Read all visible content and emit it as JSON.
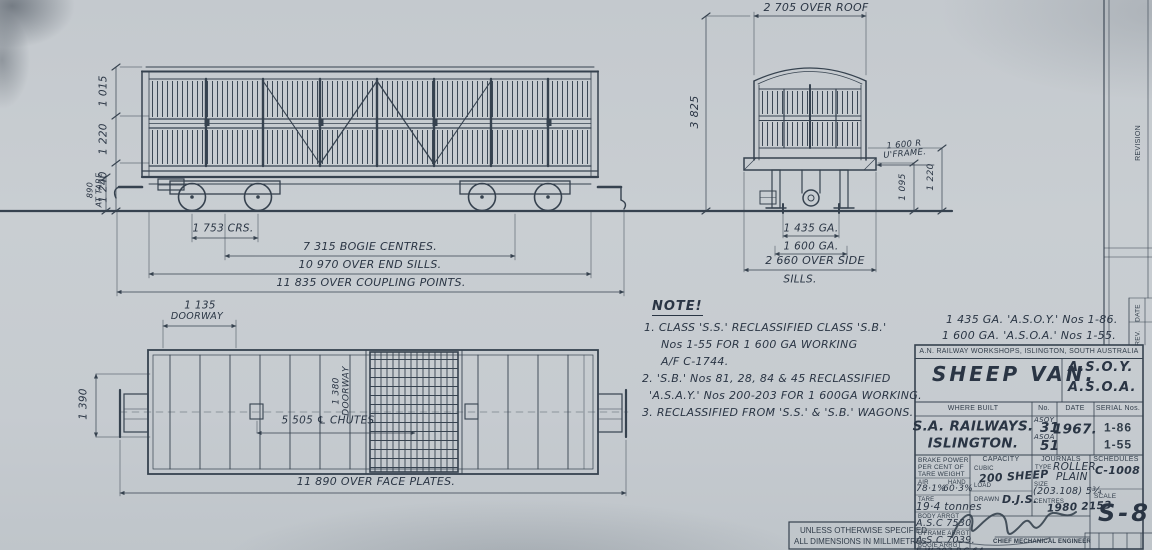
{
  "side_view": {
    "dim_top": "1 015",
    "dim_mid": "1 220",
    "dim_bottom": "1 240",
    "dim_tare_value": "890",
    "dim_tare_label": "AT TARE",
    "dim_crs": "1 753 CRS.",
    "dim_bogie_centres": "7 315 BOGIE CENTRES.",
    "dim_end_sills": "10 970 OVER END SILLS.",
    "dim_coupling": "11 835 OVER COUPLING POINTS."
  },
  "end_view": {
    "dim_over_roof": "2 705 OVER ROOF",
    "dim_height": "3 825",
    "dim_uframe_value": "1 600 R",
    "dim_uframe_label": "U'FRAME.",
    "dim_inner": "1 095",
    "dim_outer": "1 220",
    "dim_gauge_narrow": "1 435 GA.",
    "dim_gauge_broad": "1 600 GA.",
    "dim_side_sills": "2 660 OVER SIDE",
    "dim_side_sills2": "SILLS."
  },
  "plan_view": {
    "dim_end_door_value": "1 135",
    "dim_end_door_label": "DOORWAY",
    "dim_end_width": "1 390",
    "dim_side_door_value": "1 380",
    "dim_side_door_label": "DOORWAY",
    "dim_chutes": "5 505 ℄ CHUTES",
    "dim_face_plates": "11 890 OVER FACE PLATES."
  },
  "note": {
    "heading": "NOTE!",
    "lines": [
      "1. CLASS 'S.S.' RECLASSIFIED CLASS 'S.B.'",
      "Nos 1-55 FOR 1 600 GA WORKING",
      "A/F C-1744.",
      "2. 'S.B.' Nos 81, 28, 84 & 45 RECLASSIFIED",
      "'A.S.A.Y.' Nos 200-203 FOR 1 600GA WORKING.",
      "3. RECLASSIFIED FROM 'S.S.' & 'S.B.' WAGONS."
    ]
  },
  "gauge_note": {
    "line1": "1 435 GA. 'A.S.O.Y.' Nos 1-86.",
    "line2": "1 600 GA. 'A.S.O.A.' Nos 1-55."
  },
  "title_block": {
    "workshop": "A.N. RAILWAY WORKSHOPS, ISLINGTON, SOUTH AUSTRALIA",
    "title": "SHEEP VAN.",
    "code_narrow": "A.S.O.Y.",
    "code_broad": "A.S.O.A.",
    "where_built_label": "WHERE BUILT",
    "no_label": "No.",
    "date_label": "DATE",
    "serial_label": "SERIAL Nos.",
    "where_built_line1": "S.A. RAILWAYS.",
    "where_built_line2": "ISLINGTON.",
    "no1_class": "ASOY",
    "no1_value": "31",
    "no2_class": "ASOA",
    "no2_value": "51",
    "date_value": "1967.",
    "serial1": "1-86",
    "serial2": "1-55",
    "brake_line1": "BRAKE POWER",
    "brake_line2": "PER CENT OF",
    "brake_line3": "TARE WEIGHT",
    "air_label": "AIR",
    "hand_label": "HAND",
    "air_value": "78·1%",
    "hand_value": "60·3%",
    "tare_label": "TARE",
    "tare_value": "19·4 tonnes",
    "body_label": "BODY ARRGT",
    "body_value": "A.S.C 7530",
    "uframe_label": "U'FRAME ARRGT",
    "uframe_value": "A.S.C 7039.",
    "bogie_label": "BOGIE ARRGT",
    "bogie_value": "E.W.203 P.C.64",
    "capacity_label": "CAPACITY",
    "cubic_label": "CUBIC",
    "load_label": "LOAD",
    "capacity_value": "200 SHEEP",
    "drawn_label": "DRAWN",
    "drawn_value": "D.J.S.",
    "journals_label": "JOURNALS",
    "type_label": "TYPE",
    "type_value1": "ROLLER",
    "type_value2": "PLAIN",
    "size_label": "SIZE",
    "size_value": "(203.108) 5¾",
    "centres_label": "CENTRES",
    "centres_value": "1980 2153",
    "schedules_label": "SCHEDULES",
    "schedules_value": "C-1008",
    "scale_label": "SCALE",
    "engineer": "CHIEF MECHANICAL ENGINEER",
    "drawing_no": "S-8."
  },
  "margin": {
    "revision": "REVISION",
    "date": "DATE",
    "rev": "REV.",
    "spec_line1": "UNLESS OTHERWISE SPECIFIED",
    "spec_line2": "ALL DIMENSIONS IN MILLIMETRES"
  }
}
